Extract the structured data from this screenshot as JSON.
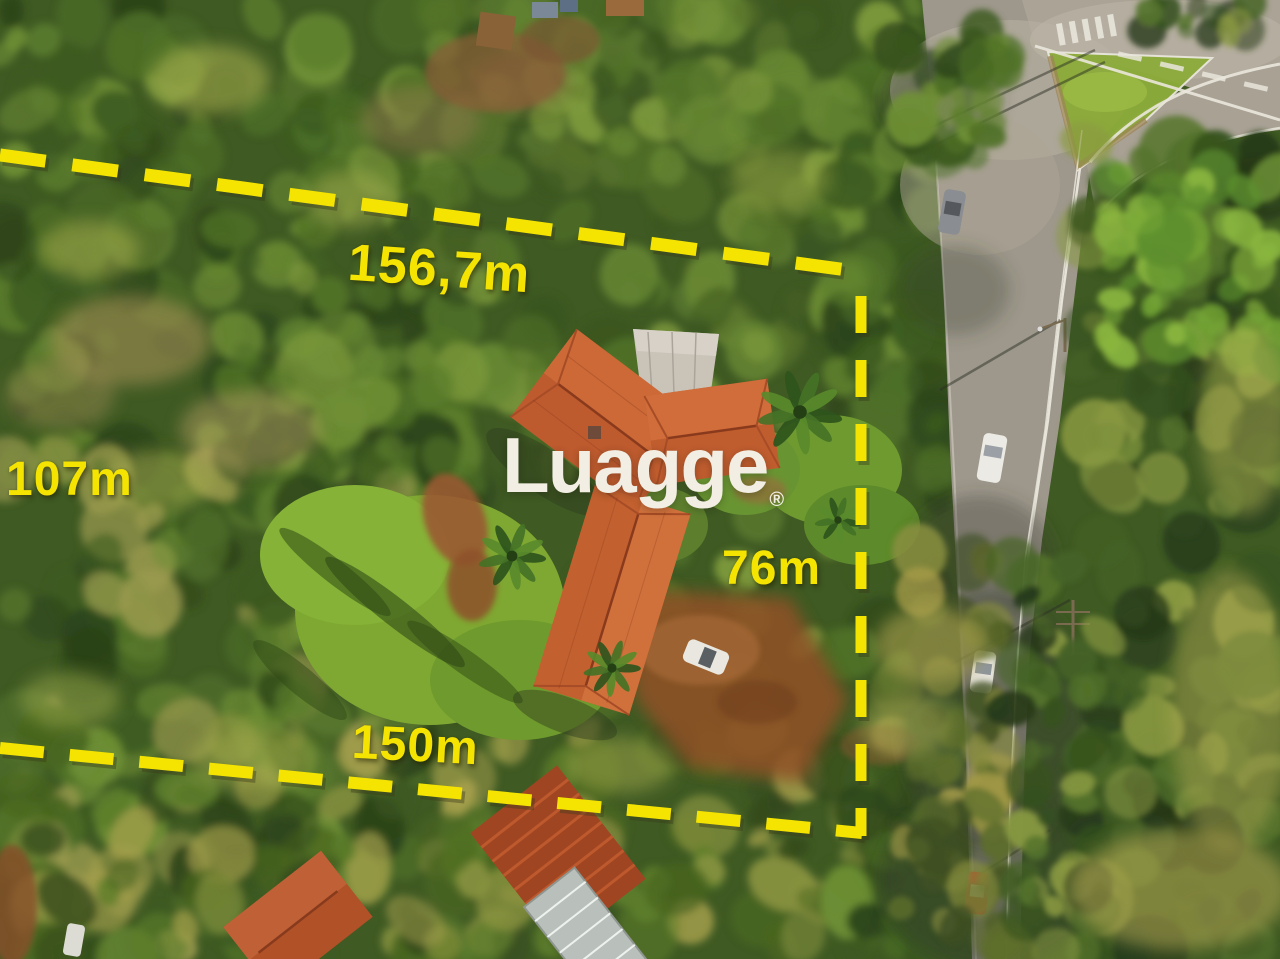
{
  "watermark": {
    "text": "Luagge",
    "registered_mark": "®",
    "color": "#f2eee3"
  },
  "boundary": {
    "color": "#f5e402",
    "measurements": {
      "top": "156,7m",
      "left": "107m",
      "right": "76m",
      "bottom": "150m"
    }
  },
  "palette": {
    "forest_green": "#3f5a23",
    "lawn_green": "#7fa832",
    "roof_terracotta": "#c05d2f",
    "road_gray": "#9e988c",
    "dirt_brown": "#8f5128",
    "boundary_yellow": "#f5e402"
  }
}
